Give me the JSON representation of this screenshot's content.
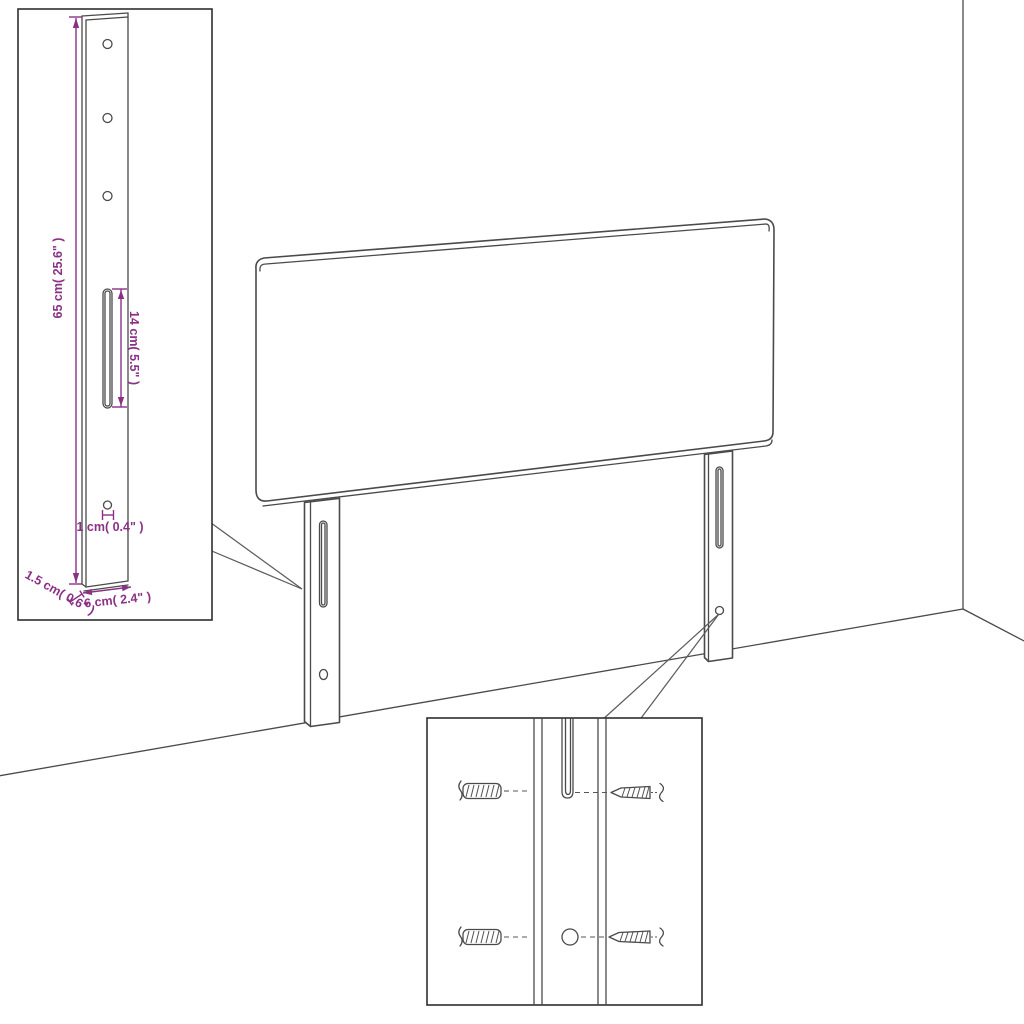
{
  "diagram": {
    "kind": "headboard-assembly-dimension-diagram",
    "colors": {
      "line": "#4a4a4a",
      "dimension": "#8B3185",
      "inset_border": "#2f2f2f",
      "background": "#ffffff"
    },
    "leg_detail_inset": {
      "labels": {
        "leg_height": "65 cm( 25.6\" )",
        "slot_length": "14 cm( 5.5\" )",
        "hole_diameter": "1 cm( 0.4\" )",
        "leg_thickness": "1.5 cm( 0.6\" )",
        "leg_width": "6 cm( 2.4\" )"
      },
      "icons": [
        "leg-board",
        "mount-hole",
        "adjustment-slot"
      ]
    },
    "hardware_inset": {
      "icons": [
        "wall-plug-icon",
        "screw-icon",
        "leg-slot",
        "leg-hole"
      ]
    },
    "main_drawing": {
      "icons": [
        "headboard-panel",
        "left-leg",
        "right-leg",
        "wall-corner",
        "floor-line"
      ]
    }
  }
}
